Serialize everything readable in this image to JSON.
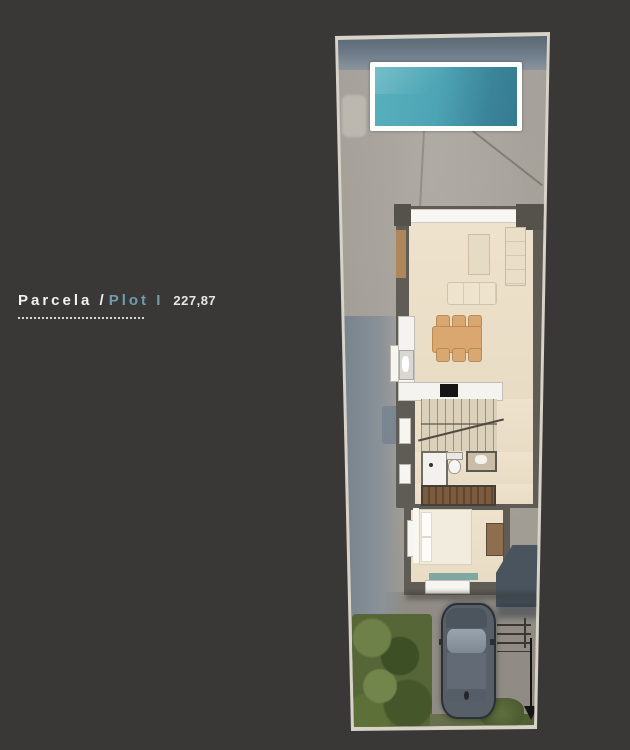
{
  "title": {
    "parcela_label": "Parcela /",
    "plot_label": "Plot I",
    "area_value": "227,87"
  },
  "colors": {
    "background": "#3a3837",
    "accent_blue": "#6f9dae",
    "pool_water": "#4aa4b4",
    "pool_frame": "#fdfdfc",
    "house_wall": "#5f5b55",
    "house_floor": "#ebdfc9",
    "concrete": "#a29d95",
    "path_blue_gray": "#76828d",
    "greenery": "#566637",
    "car_body": "#575f68",
    "annotation_black": "#141414"
  },
  "plan": {
    "regions": [
      "swimming-pool",
      "terrace",
      "living-room",
      "dining-area",
      "kitchen",
      "staircase",
      "bathroom",
      "wardrobe",
      "bedroom",
      "entry-court",
      "driveway",
      "garden",
      "parked-car"
    ],
    "furniture": [
      "sofa",
      "wall-unit",
      "rug",
      "dining-table",
      "dining-chairs",
      "kitchen-counter",
      "sink",
      "cooktop",
      "shower",
      "toilet",
      "vanity",
      "wardrobe",
      "double-bed",
      "pillows",
      "desk"
    ],
    "annotations": [
      "street-access-arrow"
    ]
  }
}
